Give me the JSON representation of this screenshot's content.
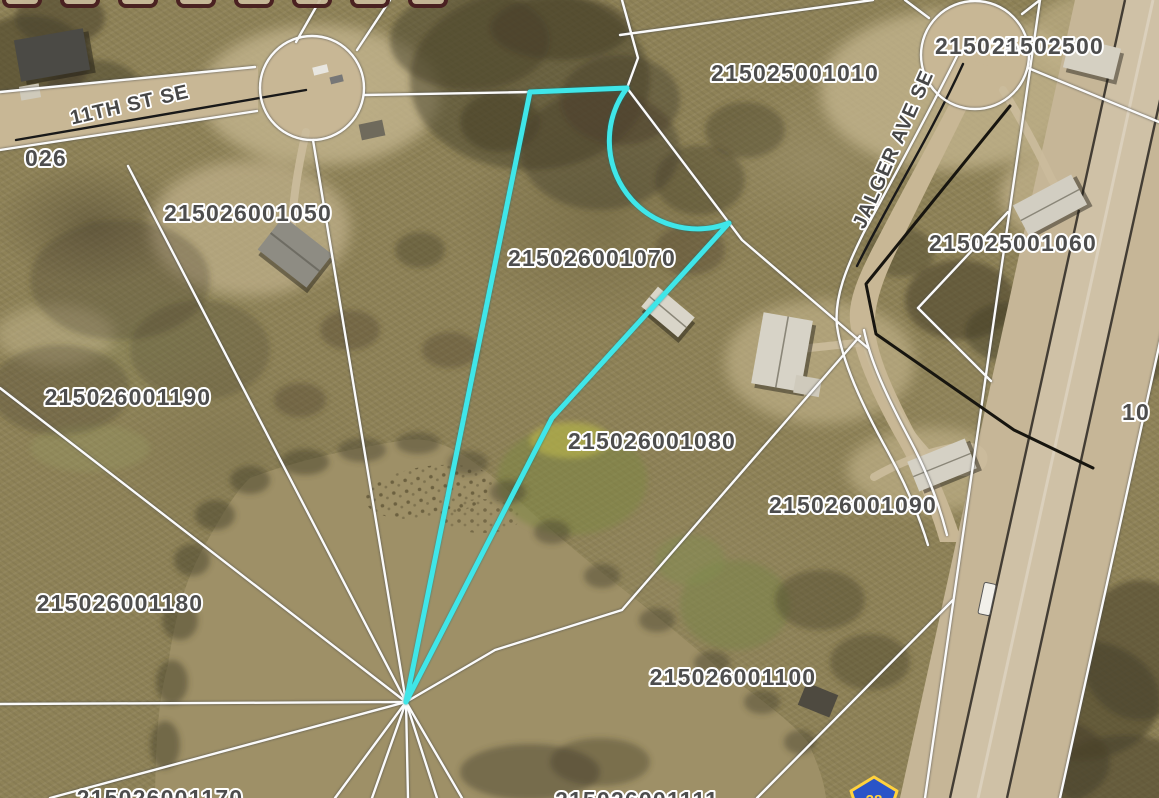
{
  "toolbar": {
    "tab_count": 8,
    "tab_color": "#4a2121"
  },
  "map": {
    "selected_parcel": "215026001070",
    "highlight_color": "#3FE6E9",
    "parcel_line_color": "#fbfbfb",
    "road_fill_color": "#c8b795",
    "label_fill_color": "#4d4d4d",
    "label_halo_color": "#ffffff",
    "parcel_labels": [
      {
        "text": "215026001050",
        "x": 248,
        "y": 221
      },
      {
        "text": "215026001070",
        "x": 592,
        "y": 266
      },
      {
        "text": "215025001010",
        "x": 795,
        "y": 81
      },
      {
        "text": "215025",
        "x": 977,
        "y": 54,
        "size": 25
      },
      {
        "text": "21502500",
        "x": 1048,
        "y": 54,
        "size": 25,
        "anchor": "start",
        "clipped": "right"
      },
      {
        "text": "215025001060",
        "x": 1013,
        "y": 251
      },
      {
        "text": "215026001190",
        "x": 128,
        "y": 405
      },
      {
        "text": "215026001080",
        "x": 652,
        "y": 449
      },
      {
        "text": "215026001090",
        "x": 853,
        "y": 513
      },
      {
        "text": "215026001180",
        "x": 120,
        "y": 611
      },
      {
        "text": "215026001100",
        "x": 733,
        "y": 685
      },
      {
        "text": "026",
        "x": 46,
        "y": 166,
        "anchor": "end",
        "clipped": "left"
      },
      {
        "text": "215026001170",
        "x": 160,
        "y": 806,
        "clipped": "bottom"
      },
      {
        "text": "215026001111",
        "x": 637,
        "y": 808,
        "clipped": "bottom"
      },
      {
        "text": "10",
        "x": 1136,
        "y": 420,
        "size": 25,
        "anchor": "start",
        "clipped": "right"
      }
    ],
    "street_labels": [
      {
        "text": "11TH ST SE",
        "x": 131,
        "y": 111,
        "angle": -13
      },
      {
        "text": "JALGER AVE SE",
        "x": 899,
        "y": 152,
        "angle": -66
      }
    ],
    "highway_shield": {
      "number": "28",
      "fill": "#2a54c8",
      "border": "#ffd23d"
    }
  }
}
